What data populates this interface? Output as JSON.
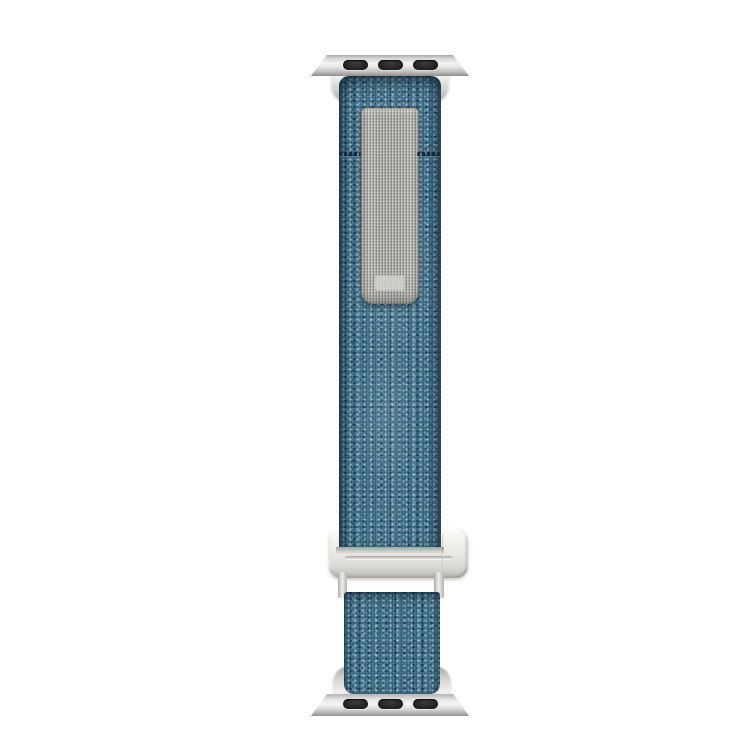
{
  "scene": {
    "description": "Product photo of a heather blue woven nylon watch band shown straightened vertically on a plain white background, with silver-tone lug adapters at both ends, a gray woven pull tab near the top and a silver G-hook slide buckle near the bottom",
    "background_color": "#ffffff"
  },
  "parts": {
    "top_adapter": "Silver watch lug adapter bar with three dark pill-shaped slots",
    "top_clamp": "Silver collar clamping the top of the fabric band",
    "main_band": "Long heather blue woven nylon strap",
    "pull_tab": "Gray woven hook-and-loop pull tab stitched onto the band",
    "tab_label": "Faint pale woven label patch near the bottom of the gray tab",
    "stitch_line": "Dark horizontal stitch line across the blue band beside the tab",
    "buckle": "Silver-tone G-hook slide buckle the band threads through",
    "buckle_legs": "Thin silver posts joining the buckle to the end loop",
    "bottom_strap": "Short heather blue woven end loop below the buckle",
    "bottom_adapter": "Silver watch lug adapter bar with three dark pill-shaped slots"
  },
  "details": {
    "adapter_slot_count": 3,
    "band_orientation": "vertical"
  },
  "colors": {
    "background": "#ffffff",
    "fabric_base": "#3c6a84",
    "fabric_dark": "#224d66",
    "fabric_light": "#8fb6c2",
    "fabric_pale": "#cfe2e2",
    "tab_base": "#a9a8a0",
    "tab_light": "#c6c5bd",
    "tab_dark": "#84837b",
    "metal_light": "#f4f4f2",
    "metal_mid": "#d6d6d4",
    "metal_dark": "#8e8e8c",
    "slot_color": "#1e1e1e",
    "stitch_color": "#16293a"
  }
}
